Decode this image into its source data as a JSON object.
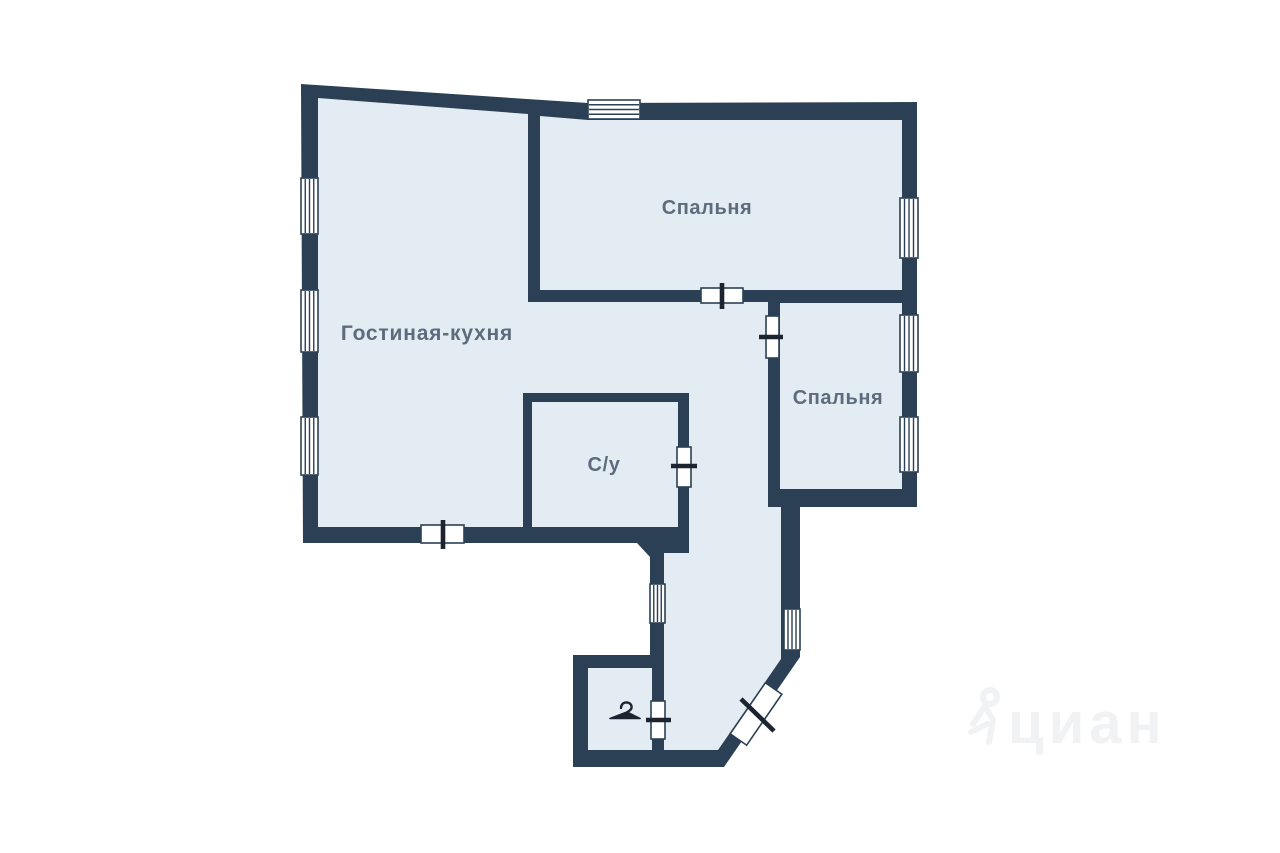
{
  "rooms": {
    "living": {
      "label": "Гостиная-кухня"
    },
    "bedroom1": {
      "label": "Спальня"
    },
    "bedroom2": {
      "label": "Спальня"
    },
    "bathroom": {
      "label": "С/у"
    }
  },
  "icons": {
    "closet": "coat-hanger-icon"
  },
  "watermark": {
    "text": "циан"
  },
  "colors": {
    "wall": "#2b4054",
    "room_fill": "#e4ecf3",
    "label": "#5c6c7c",
    "door_line": "#1b2430",
    "background": "#ffffff",
    "watermark": "#f1f2f4"
  }
}
